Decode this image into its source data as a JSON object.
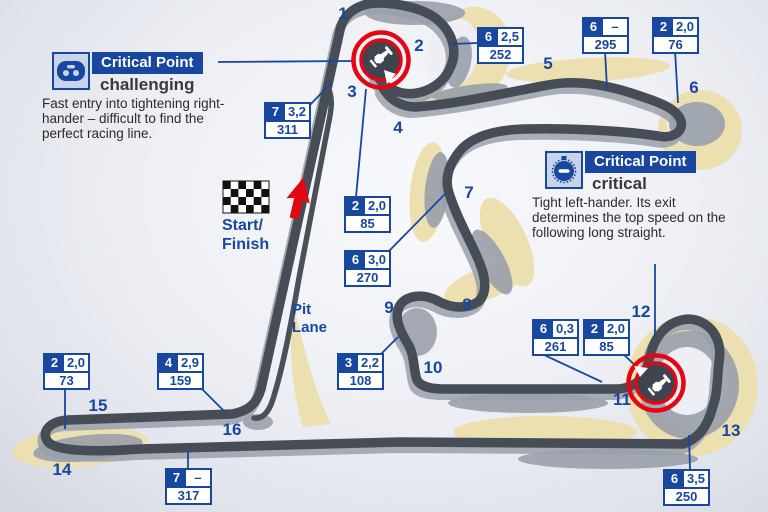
{
  "map": {
    "corners": [
      {
        "n": "1",
        "x": 343,
        "y": 14
      },
      {
        "n": "2",
        "x": 419,
        "y": 46
      },
      {
        "n": "3",
        "x": 352,
        "y": 92
      },
      {
        "n": "4",
        "x": 398,
        "y": 128
      },
      {
        "n": "5",
        "x": 548,
        "y": 64
      },
      {
        "n": "6",
        "x": 694,
        "y": 88
      },
      {
        "n": "7",
        "x": 469,
        "y": 193
      },
      {
        "n": "8",
        "x": 467,
        "y": 305
      },
      {
        "n": "9",
        "x": 389,
        "y": 308
      },
      {
        "n": "10",
        "x": 433,
        "y": 368
      },
      {
        "n": "11",
        "x": 622,
        "y": 400
      },
      {
        "n": "12",
        "x": 641,
        "y": 312
      },
      {
        "n": "13",
        "x": 731,
        "y": 431
      },
      {
        "n": "14",
        "x": 62,
        "y": 470
      },
      {
        "n": "15",
        "x": 98,
        "y": 406
      },
      {
        "n": "16",
        "x": 232,
        "y": 430
      }
    ],
    "start_finish": [
      "Start/",
      "Finish"
    ],
    "pit_lane": [
      "Pit",
      "Lane"
    ]
  },
  "data_boxes": [
    {
      "gear": "7",
      "value": "3,2",
      "speed": "311",
      "x": 264,
      "y": 102
    },
    {
      "gear": "6",
      "value": "2,5",
      "speed": "252",
      "x": 477,
      "y": 27
    },
    {
      "gear": "6",
      "value": "–",
      "speed": "295",
      "x": 582,
      "y": 17
    },
    {
      "gear": "2",
      "value": "2,0",
      "speed": "76",
      "x": 652,
      "y": 17
    },
    {
      "gear": "2",
      "value": "2,0",
      "speed": "85",
      "x": 344,
      "y": 196
    },
    {
      "gear": "6",
      "value": "3,0",
      "speed": "270",
      "x": 344,
      "y": 250
    },
    {
      "gear": "3",
      "value": "2,2",
      "speed": "108",
      "x": 337,
      "y": 353
    },
    {
      "gear": "6",
      "value": "0,3",
      "speed": "261",
      "x": 532,
      "y": 319
    },
    {
      "gear": "2",
      "value": "2,0",
      "speed": "85",
      "x": 583,
      "y": 319
    },
    {
      "gear": "6",
      "value": "3,5",
      "speed": "250",
      "x": 663,
      "y": 469
    },
    {
      "gear": "2",
      "value": "2,0",
      "speed": "73",
      "x": 43,
      "y": 353
    },
    {
      "gear": "4",
      "value": "2,9",
      "speed": "159",
      "x": 157,
      "y": 353
    },
    {
      "gear": "7",
      "value": "–",
      "speed": "317",
      "x": 165,
      "y": 468
    }
  ],
  "cards": [
    {
      "title": "Critical Point",
      "severity": "challenging",
      "description": "Fast entry into tightening right-hander – difficult to find the perfect racing line.",
      "icon": "steering-wheel-icon"
    },
    {
      "title": "Critical Point",
      "severity": "critical",
      "description": "Tight left-hander. Its exit determines the top speed on the following long straight.",
      "icon": "stopwatch-icon"
    }
  ],
  "colors": {
    "blue": "#17479e",
    "track": "#474d56",
    "track_shadow": "#9aa0ab",
    "runoff": "#ecdfb0",
    "red": "#e30613",
    "background": "#edeff4"
  }
}
